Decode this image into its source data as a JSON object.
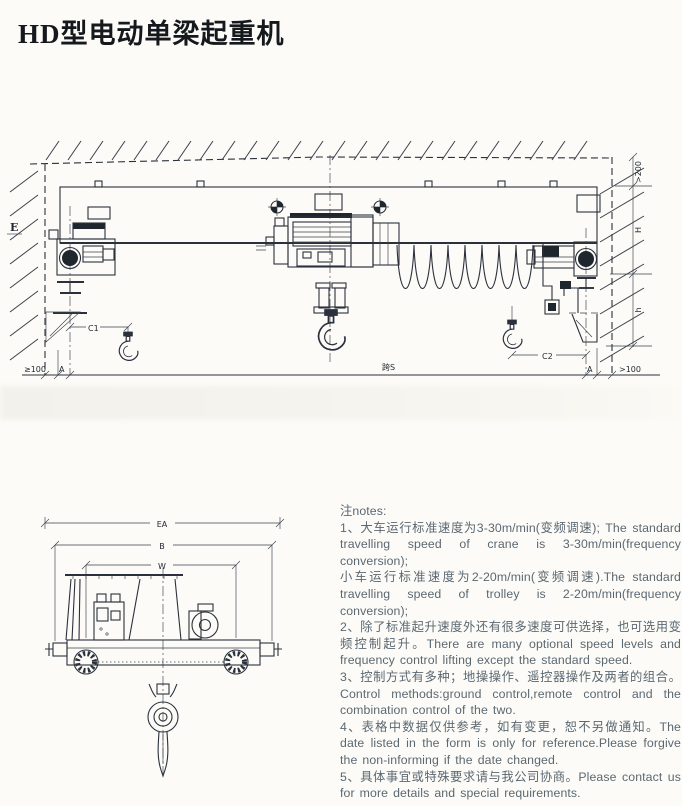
{
  "page": {
    "title": "HD型电动单梁起重机",
    "ink_color": "#2b313c",
    "note_color": "#5b6872",
    "background": "#fcfbf7"
  },
  "main_drawing": {
    "description": "crane front elevation between walls",
    "labels": {
      "wall_left": "E",
      "ceiling_clearance": ">200",
      "height_H": "H",
      "height_h": "h",
      "hook_approach_left": "C1",
      "hook_approach_right": "C2",
      "span": "跨S",
      "clearance_left": "≥100",
      "clearance_right": ">100",
      "rail_margin_left": "A",
      "rail_margin_right": "A"
    }
  },
  "end_view": {
    "description": "crane end carriage side view with hook",
    "labels": {
      "overall_width": "EA",
      "carriage_length": "B",
      "wheel_base": "W"
    }
  },
  "notes": {
    "heading": "注notes:",
    "items": [
      "1、大车运行标准速度为3-30m/min(变频调速); The standard travelling speed of crane is 3-30m/min(frequency conversion);",
      "小车运行标准速度为2-20m/min(变频调速).The standard travelling speed of trolley is 2-20m/min(frequency conversion);",
      "2、除了标准起升速度外还有很多速度可供选择，也可选用变频控制起升。There are many optional speed levels and frequency control lifting except the standard speed.",
      "3、控制方式有多种；地操操作、遥控器操作及两者的组合。Control methods:ground control,remote control and the combination control of the two.",
      "4、表格中数据仅供参考，如有变更，恕不另做通知。The date listed in the form is only for reference.Please forgive the non-informing if the date changed.",
      "5、具体事宜或特殊要求请与我公司协商。Please contact us for more details and special requirements."
    ]
  }
}
